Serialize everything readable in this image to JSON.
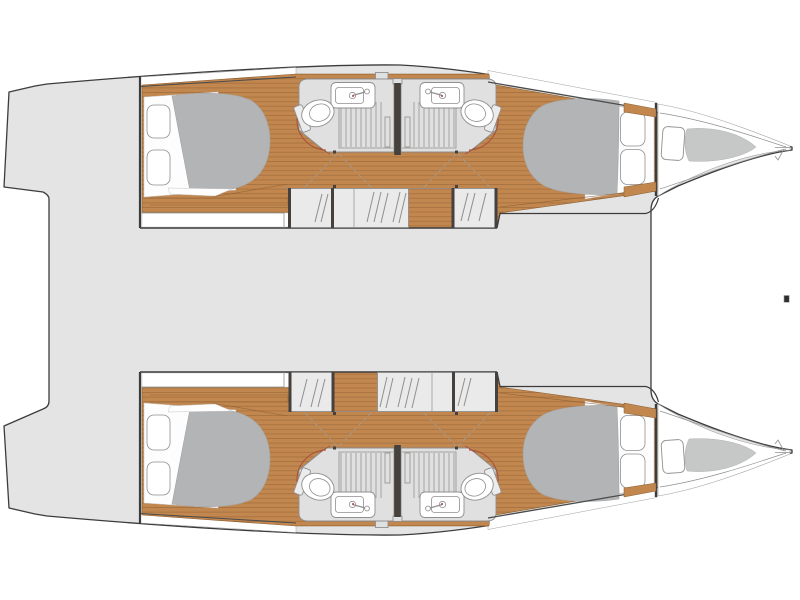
{
  "canvas": {
    "width": 800,
    "height": 600,
    "background": "#ffffff"
  },
  "colors": {
    "outline": "#3c3c3c",
    "deck": "#e3e4e3",
    "white": "#ffffff",
    "wood": "#c1874f",
    "wood_line": "#a06b3a",
    "wood_edge": "#8a5c2f",
    "bed": "#b3b4b5",
    "bed_edge": "#a3a4a5",
    "cushion": "#c6c7c7",
    "cushion_edge": "#b2b3b3",
    "bathroom": "#dfe0df",
    "steps": "#eaeaea",
    "fixture": "#8f8f8f",
    "line_light": "#9f9f9f",
    "coach_line": "#4a4a4a",
    "dark_wall": "#46413c",
    "accent": "#a84f3c",
    "mark": "#2e2e2e",
    "mattress": "#fdfdfd",
    "soft": "#c9c9c9"
  },
  "plan": {
    "vessel": "catamaran",
    "view": "overhead-deck-plan",
    "hulls": [
      {
        "side": "port",
        "position": "top",
        "parts": [
          "aft-double-berth",
          "two-aft-pillows",
          "aft-bathroom",
          "forward-bathroom",
          "companionway-steps",
          "forward-double-berth",
          "two-forward-pillows",
          "bow-hatch",
          "bow-cushion",
          "bow-roller"
        ]
      },
      {
        "side": "starboard",
        "position": "bottom",
        "parts": [
          "aft-double-berth",
          "two-aft-pillows",
          "aft-bathroom",
          "forward-bathroom",
          "companionway-steps",
          "forward-double-berth",
          "two-forward-pillows",
          "bow-hatch",
          "bow-cushion",
          "bow-roller"
        ]
      }
    ],
    "bathroom_fixtures": [
      "sink",
      "toilet",
      "shower-grate"
    ],
    "deck_features": [
      "bridge-deck",
      "stern-platform-notch",
      "centerline-fitting-mark"
    ]
  }
}
